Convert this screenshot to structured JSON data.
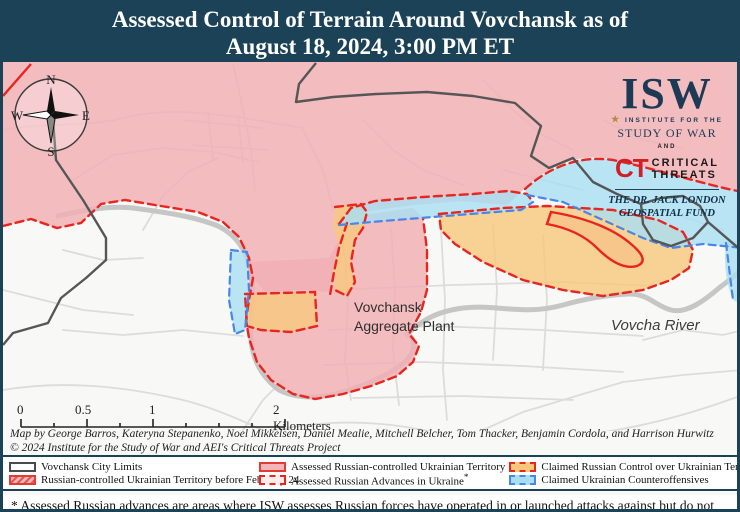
{
  "title": {
    "line1": "Assessed Control of Terrain Around Vovchansk as of",
    "line2": "August 18, 2024, 3:00 PM ET"
  },
  "colors": {
    "header_navy": "#1b4257",
    "russian_controlled_pink": "#f4b6ba",
    "russian_advance_red": "#e8251f",
    "claimed_russian_orange": "#f6c87c",
    "claimed_ukrainian_blue": "#a8dff2",
    "ukrainian_dash_blue": "#4a86e8",
    "road_gray": "#dcdcdc",
    "river_gray": "#c6c6c6",
    "city_limits_gray": "#565656",
    "map_background": "#f8f8f6"
  },
  "logo": {
    "isw": "ISW",
    "institute": "INSTITUTE FOR THE",
    "star": "★",
    "study": "STUDY OF WAR",
    "and": "AND",
    "ct": "CT",
    "critical": "CRITICAL",
    "threats": "THREATS",
    "fund_line1": "THE DR. JACK LONDON",
    "fund_line2": "GEOSPATIAL FUND"
  },
  "compass": {
    "n": "N",
    "e": "E",
    "s": "S",
    "w": "W"
  },
  "map_labels": {
    "plant_line1": "Vovchansk",
    "plant_line2": "Aggregate Plant",
    "river": "Vovcha River"
  },
  "scale": {
    "tick0": "0",
    "tick05": "0.5",
    "tick1": "1",
    "tick2": "2 Kilometers"
  },
  "attribution": {
    "line1": "Map by George Barros, Kateryna Stepanenko, Noel Mikkelsen, Daniel Mealie, Mitchell Belcher, Tom Thacker, Benjamin Cordola, and Harrison Hurwitz",
    "line2": "© 2024 Institute for the Study of War and AEI's Critical Threats Project"
  },
  "legend": {
    "items": [
      {
        "label": "Vovchansk City Limits",
        "suffix": ""
      },
      {
        "label": "Russian-controlled Ukrainian Territory before February 24",
        "suffix": ""
      },
      {
        "label": "Assessed Russian-controlled Ukrainian Territory",
        "suffix": ""
      },
      {
        "label": "Assessed Russian Advances in Ukraine",
        "suffix": "*"
      },
      {
        "label": "Claimed Russian Control over Ukrainian Territory",
        "suffix": ""
      },
      {
        "label": "Claimed Ukrainian Counteroffensives",
        "suffix": ""
      }
    ]
  },
  "footnote": "* Assessed Russian advances are areas where ISW assesses Russian forces have operated in or launched attacks against but do not control."
}
